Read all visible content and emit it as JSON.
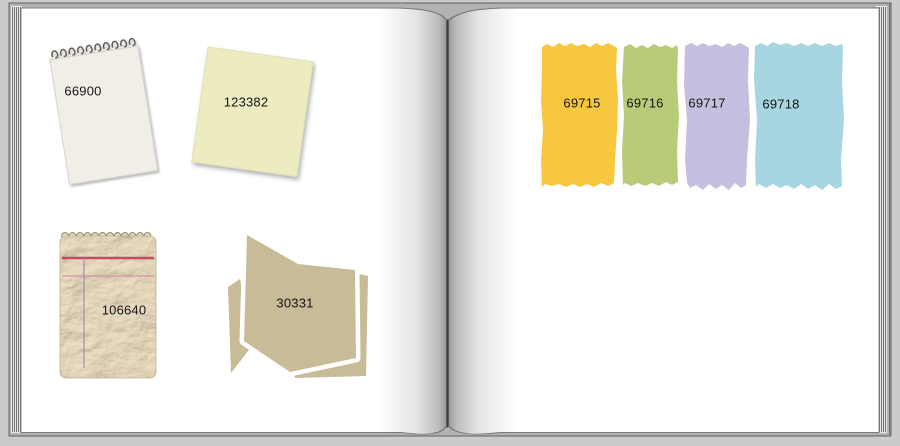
{
  "book": {
    "frame": {
      "background": "#cbcbcb",
      "cover": "#b2b2b2",
      "page": "#ffffff"
    },
    "left_page": {
      "items": [
        {
          "name": "cream-notepad",
          "label": "66900",
          "color": "#f1eee7"
        },
        {
          "name": "yellow-paper",
          "label": "123382",
          "color": "#ececc0"
        },
        {
          "name": "textured-notepad",
          "label": "106640",
          "color": "#e2d8bc",
          "line_colors": {
            "top": "#c64a63",
            "second": "#d795a0",
            "vertical": "#9187a5"
          }
        },
        {
          "name": "paper-stack",
          "label": "30331",
          "color": "#c7bb98"
        }
      ]
    },
    "right_page": {
      "strips": [
        {
          "name": "torn-strip-yellow",
          "label": "69715",
          "color": "#f7c73f"
        },
        {
          "name": "torn-strip-green",
          "label": "69716",
          "color": "#b8cc78"
        },
        {
          "name": "torn-strip-purple",
          "label": "69717",
          "color": "#c6bfe0"
        },
        {
          "name": "torn-strip-blue",
          "label": "69718",
          "color": "#a8d5e2"
        }
      ]
    }
  }
}
